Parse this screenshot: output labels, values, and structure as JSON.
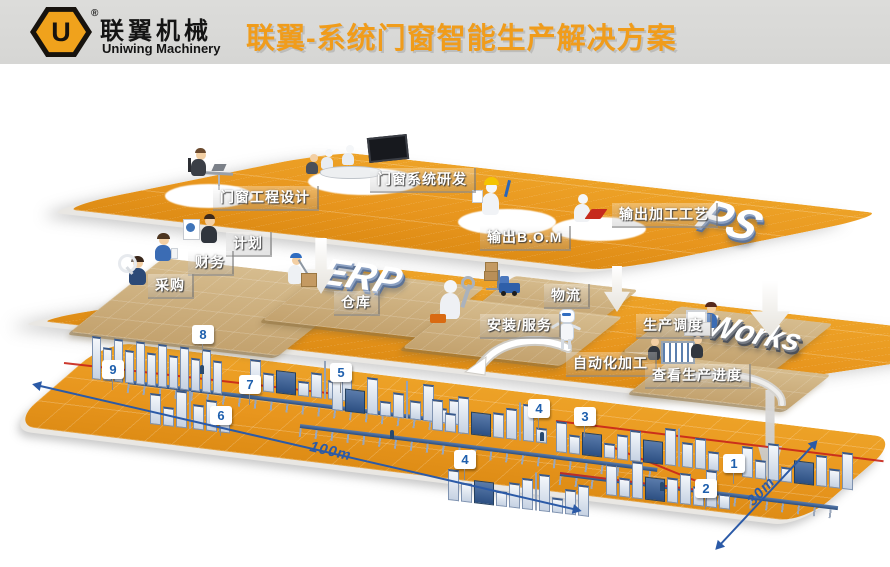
{
  "header": {
    "logo": {
      "symbol": "U",
      "registered_mark": "®",
      "name_cn": "联翼机械",
      "name_en": "Uniwing Machinery"
    },
    "title": "联翼-系统门窗智能生产解决方案"
  },
  "layers": {
    "top": {
      "big_label": "PS",
      "stations": [
        {
          "label": "门窗工程设计"
        },
        {
          "label": "门窗系统研发"
        },
        {
          "label": "输出B.O.M"
        },
        {
          "label": "输出加工工艺"
        }
      ]
    },
    "middle": {
      "big_label_left": "ERP",
      "big_label_right": "eWorks",
      "stations": [
        {
          "label": "计划"
        },
        {
          "label": "财务"
        },
        {
          "label": "采购"
        },
        {
          "label": "仓库"
        },
        {
          "label": "物流"
        },
        {
          "label": "安装/服务"
        },
        {
          "label": "生产调度"
        },
        {
          "label": "自动化加工"
        },
        {
          "label": "查看生产进度"
        }
      ]
    },
    "floor": {
      "badges": [
        {
          "number": "8"
        },
        {
          "number": "9"
        },
        {
          "number": "7"
        },
        {
          "number": "6"
        },
        {
          "number": "5"
        },
        {
          "number": "4"
        },
        {
          "number": "3"
        },
        {
          "number": "4"
        },
        {
          "number": "1"
        },
        {
          "number": "2"
        }
      ],
      "dimensions": {
        "length": "100m",
        "width": "30m"
      }
    }
  },
  "colors": {
    "platform_orange": "#E8961E",
    "title_orange": "#F09C1B",
    "badge_blue": "#1E5FAD",
    "dimension_blue": "#2B5AA7",
    "flow_red": "#C8271B",
    "mat_tan": "#C9AC7C"
  }
}
